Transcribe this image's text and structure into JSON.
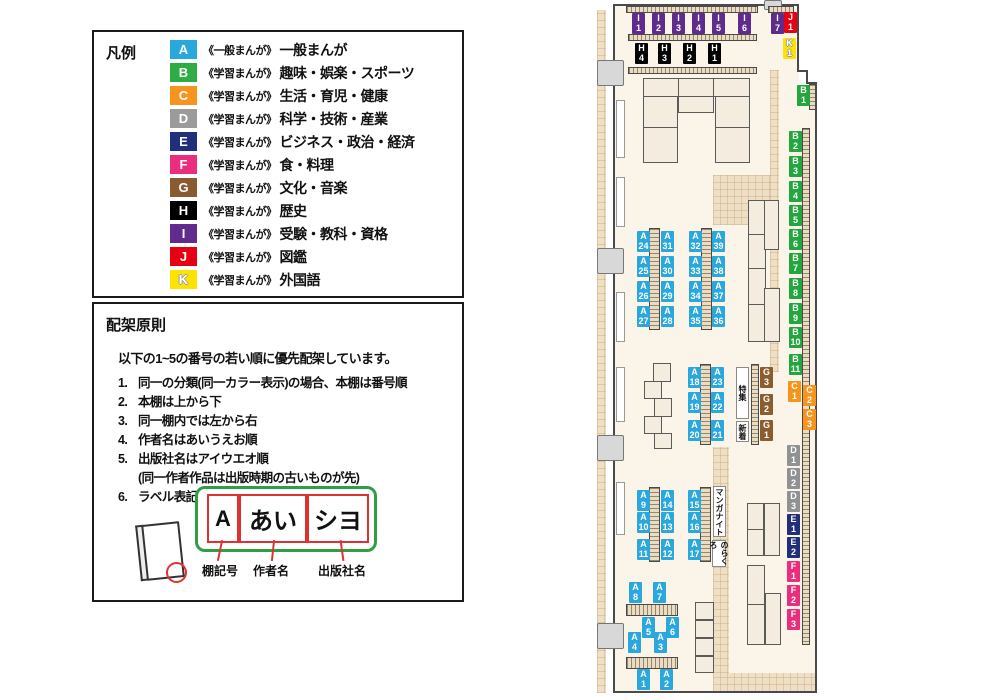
{
  "legend": {
    "title": "凡例",
    "items": [
      {
        "code": "A",
        "color": "#2AA7DC",
        "series": "《一般まんが》",
        "category": "一般まんが",
        "outline": false
      },
      {
        "code": "B",
        "color": "#2EAD44",
        "series": "《学習まんが》",
        "category": "趣味・娯楽・スポーツ",
        "outline": false
      },
      {
        "code": "C",
        "color": "#F7941D",
        "series": "《学習まんが》",
        "category": "生活・育児・健康",
        "outline": false
      },
      {
        "code": "D",
        "color": "#9B9B9B",
        "series": "《学習まんが》",
        "category": "科学・技術・産業",
        "outline": false
      },
      {
        "code": "E",
        "color": "#1F2F7C",
        "series": "《学習まんが》",
        "category": "ビジネス・政治・経済",
        "outline": false
      },
      {
        "code": "F",
        "color": "#EB2D7D",
        "series": "《学習まんが》",
        "category": "食・料理",
        "outline": false
      },
      {
        "code": "G",
        "color": "#8A5B2F",
        "series": "《学習まんが》",
        "category": "文化・音楽",
        "outline": false
      },
      {
        "code": "H",
        "color": "#000000",
        "series": "《学習まんが》",
        "category": "歴史",
        "outline": false
      },
      {
        "code": "I",
        "color": "#5F2B8D",
        "series": "《学習まんが》",
        "category": "受験・教科・資格",
        "outline": false
      },
      {
        "code": "J",
        "color": "#E60012",
        "series": "《学習まんが》",
        "category": "図鑑",
        "outline": false
      },
      {
        "code": "K",
        "color": "#FFE300",
        "series": "《学習まんが》",
        "category": "外国語",
        "outline": true
      }
    ]
  },
  "principles": {
    "title": "配架原則",
    "intro": "以下の1~5の番号の若い順に優先配架しています。",
    "rules": [
      {
        "num": "1.",
        "text": "同一の分類(同一カラー表示)の場合、本棚は番号順",
        "sub": ""
      },
      {
        "num": "2.",
        "text": "本棚は上から下",
        "sub": ""
      },
      {
        "num": "3.",
        "text": "同一棚内では左から右",
        "sub": ""
      },
      {
        "num": "4.",
        "text": "作者名はあいうえお順",
        "sub": ""
      },
      {
        "num": "5.",
        "text": "出版社名はアイウエオ順",
        "sub": "(同一作者作品は出版時期の古いものが先)"
      },
      {
        "num": "6.",
        "text": "ラベル表記は下図の通り",
        "sub": ""
      }
    ],
    "label_example": {
      "parts": [
        {
          "text": "A",
          "caption": "棚記号"
        },
        {
          "text": "あい",
          "caption": "作者名"
        },
        {
          "text": "シヨ",
          "caption": "出版社名"
        }
      ]
    }
  },
  "map": {
    "group_colors": {
      "A": "#2AA7DC",
      "B": "#21A73E",
      "C": "#F7941D",
      "D": "#8F9192",
      "E": "#1F2F7C",
      "F": "#EB2D7D",
      "G": "#8A5C2E",
      "H": "#000000",
      "I": "#5F2B8D",
      "J": "#E60012",
      "K": "#FFE300"
    },
    "labels": [
      {
        "l1": "I",
        "l2": "1",
        "g": "I",
        "x": 632,
        "y": 13
      },
      {
        "l1": "I",
        "l2": "2",
        "g": "I",
        "x": 652,
        "y": 13
      },
      {
        "l1": "I",
        "l2": "3",
        "g": "I",
        "x": 672,
        "y": 13
      },
      {
        "l1": "I",
        "l2": "4",
        "g": "I",
        "x": 692,
        "y": 13
      },
      {
        "l1": "I",
        "l2": "5",
        "g": "I",
        "x": 712,
        "y": 13
      },
      {
        "l1": "I",
        "l2": "6",
        "g": "I",
        "x": 738,
        "y": 13
      },
      {
        "l1": "I",
        "l2": "7",
        "g": "I",
        "x": 771,
        "y": 13
      },
      {
        "l1": "J",
        "l2": "1",
        "g": "J",
        "x": 784,
        "y": 12
      },
      {
        "l1": "K",
        "l2": "1",
        "g": "K",
        "x": 783,
        "y": 38
      },
      {
        "l1": "H",
        "l2": "4",
        "g": "H",
        "x": 635,
        "y": 43
      },
      {
        "l1": "H",
        "l2": "3",
        "g": "H",
        "x": 658,
        "y": 43
      },
      {
        "l1": "H",
        "l2": "2",
        "g": "H",
        "x": 683,
        "y": 43
      },
      {
        "l1": "H",
        "l2": "1",
        "g": "H",
        "x": 708,
        "y": 43
      },
      {
        "l1": "B",
        "l2": "1",
        "g": "B",
        "x": 797,
        "y": 85
      },
      {
        "l1": "B",
        "l2": "2",
        "g": "B",
        "x": 789,
        "y": 131
      },
      {
        "l1": "B",
        "l2": "3",
        "g": "B",
        "x": 789,
        "y": 156
      },
      {
        "l1": "B",
        "l2": "4",
        "g": "B",
        "x": 789,
        "y": 181
      },
      {
        "l1": "B",
        "l2": "5",
        "g": "B",
        "x": 789,
        "y": 205
      },
      {
        "l1": "B",
        "l2": "6",
        "g": "B",
        "x": 789,
        "y": 229
      },
      {
        "l1": "B",
        "l2": "7",
        "g": "B",
        "x": 789,
        "y": 253
      },
      {
        "l1": "B",
        "l2": "8",
        "g": "B",
        "x": 789,
        "y": 278
      },
      {
        "l1": "B",
        "l2": "9",
        "g": "B",
        "x": 789,
        "y": 303
      },
      {
        "l1": "B",
        "l2": "10",
        "g": "B",
        "x": 789,
        "y": 327
      },
      {
        "l1": "B",
        "l2": "11",
        "g": "B",
        "x": 789,
        "y": 354
      },
      {
        "l1": "C",
        "l2": "1",
        "g": "C",
        "x": 788,
        "y": 381
      },
      {
        "l1": "C",
        "l2": "2",
        "g": "C",
        "x": 803,
        "y": 385
      },
      {
        "l1": "C",
        "l2": "3",
        "g": "C",
        "x": 803,
        "y": 409
      },
      {
        "l1": "D",
        "l2": "1",
        "g": "D",
        "x": 787,
        "y": 445
      },
      {
        "l1": "D",
        "l2": "2",
        "g": "D",
        "x": 787,
        "y": 468
      },
      {
        "l1": "D",
        "l2": "3",
        "g": "D",
        "x": 787,
        "y": 491
      },
      {
        "l1": "E",
        "l2": "1",
        "g": "E",
        "x": 787,
        "y": 514
      },
      {
        "l1": "E",
        "l2": "2",
        "g": "E",
        "x": 787,
        "y": 537
      },
      {
        "l1": "F",
        "l2": "1",
        "g": "F",
        "x": 787,
        "y": 561
      },
      {
        "l1": "F",
        "l2": "2",
        "g": "F",
        "x": 787,
        "y": 585
      },
      {
        "l1": "F",
        "l2": "3",
        "g": "F",
        "x": 787,
        "y": 609
      },
      {
        "l1": "G",
        "l2": "3",
        "g": "G",
        "x": 760,
        "y": 367
      },
      {
        "l1": "G",
        "l2": "2",
        "g": "G",
        "x": 760,
        "y": 394
      },
      {
        "l1": "G",
        "l2": "1",
        "g": "G",
        "x": 760,
        "y": 420
      },
      {
        "l1": "A",
        "l2": "24",
        "g": "A",
        "x": 637,
        "y": 231
      },
      {
        "l1": "A",
        "l2": "25",
        "g": "A",
        "x": 637,
        "y": 256
      },
      {
        "l1": "A",
        "l2": "26",
        "g": "A",
        "x": 637,
        "y": 281
      },
      {
        "l1": "A",
        "l2": "27",
        "g": "A",
        "x": 637,
        "y": 306
      },
      {
        "l1": "A",
        "l2": "31",
        "g": "A",
        "x": 661,
        "y": 231
      },
      {
        "l1": "A",
        "l2": "30",
        "g": "A",
        "x": 661,
        "y": 256
      },
      {
        "l1": "A",
        "l2": "29",
        "g": "A",
        "x": 661,
        "y": 281
      },
      {
        "l1": "A",
        "l2": "28",
        "g": "A",
        "x": 661,
        "y": 306
      },
      {
        "l1": "A",
        "l2": "32",
        "g": "A",
        "x": 689,
        "y": 231
      },
      {
        "l1": "A",
        "l2": "33",
        "g": "A",
        "x": 689,
        "y": 256
      },
      {
        "l1": "A",
        "l2": "34",
        "g": "A",
        "x": 689,
        "y": 281
      },
      {
        "l1": "A",
        "l2": "35",
        "g": "A",
        "x": 689,
        "y": 306
      },
      {
        "l1": "A",
        "l2": "39",
        "g": "A",
        "x": 712,
        "y": 231
      },
      {
        "l1": "A",
        "l2": "38",
        "g": "A",
        "x": 712,
        "y": 256
      },
      {
        "l1": "A",
        "l2": "37",
        "g": "A",
        "x": 712,
        "y": 281
      },
      {
        "l1": "A",
        "l2": "36",
        "g": "A",
        "x": 712,
        "y": 306
      },
      {
        "l1": "A",
        "l2": "18",
        "g": "A",
        "x": 688,
        "y": 367
      },
      {
        "l1": "A",
        "l2": "19",
        "g": "A",
        "x": 688,
        "y": 392
      },
      {
        "l1": "A",
        "l2": "20",
        "g": "A",
        "x": 688,
        "y": 420
      },
      {
        "l1": "A",
        "l2": "23",
        "g": "A",
        "x": 711,
        "y": 367
      },
      {
        "l1": "A",
        "l2": "22",
        "g": "A",
        "x": 711,
        "y": 392
      },
      {
        "l1": "A",
        "l2": "21",
        "g": "A",
        "x": 711,
        "y": 420
      },
      {
        "l1": "A",
        "l2": "9",
        "g": "A",
        "x": 637,
        "y": 490
      },
      {
        "l1": "A",
        "l2": "10",
        "g": "A",
        "x": 637,
        "y": 512
      },
      {
        "l1": "A",
        "l2": "11",
        "g": "A",
        "x": 637,
        "y": 539
      },
      {
        "l1": "A",
        "l2": "14",
        "g": "A",
        "x": 661,
        "y": 490
      },
      {
        "l1": "A",
        "l2": "13",
        "g": "A",
        "x": 661,
        "y": 512
      },
      {
        "l1": "A",
        "l2": "12",
        "g": "A",
        "x": 661,
        "y": 539
      },
      {
        "l1": "A",
        "l2": "15",
        "g": "A",
        "x": 688,
        "y": 490
      },
      {
        "l1": "A",
        "l2": "16",
        "g": "A",
        "x": 688,
        "y": 512
      },
      {
        "l1": "A",
        "l2": "17",
        "g": "A",
        "x": 688,
        "y": 539
      },
      {
        "l1": "A",
        "l2": "8",
        "g": "A",
        "x": 629,
        "y": 582
      },
      {
        "l1": "A",
        "l2": "7",
        "g": "A",
        "x": 653,
        "y": 582
      },
      {
        "l1": "A",
        "l2": "5",
        "g": "A",
        "x": 642,
        "y": 617
      },
      {
        "l1": "A",
        "l2": "6",
        "g": "A",
        "x": 666,
        "y": 617
      },
      {
        "l1": "A",
        "l2": "4",
        "g": "A",
        "x": 628,
        "y": 632
      },
      {
        "l1": "A",
        "l2": "3",
        "g": "A",
        "x": 654,
        "y": 632
      },
      {
        "l1": "A",
        "l2": "1",
        "g": "A",
        "x": 637,
        "y": 669
      },
      {
        "l1": "A",
        "l2": "2",
        "g": "A",
        "x": 660,
        "y": 669
      }
    ],
    "info_boxes": [
      {
        "text": "特集",
        "x": 736,
        "y": 367,
        "w": 13,
        "h": 52
      },
      {
        "text": "新着",
        "x": 736,
        "y": 421,
        "w": 13,
        "h": 21
      },
      {
        "text": "マンガナイト",
        "x": 713,
        "y": 486,
        "w": 13,
        "h": 51
      },
      {
        "text": "のらくろ",
        "x": 712,
        "y": 540,
        "w": 14,
        "h": 27
      }
    ]
  }
}
